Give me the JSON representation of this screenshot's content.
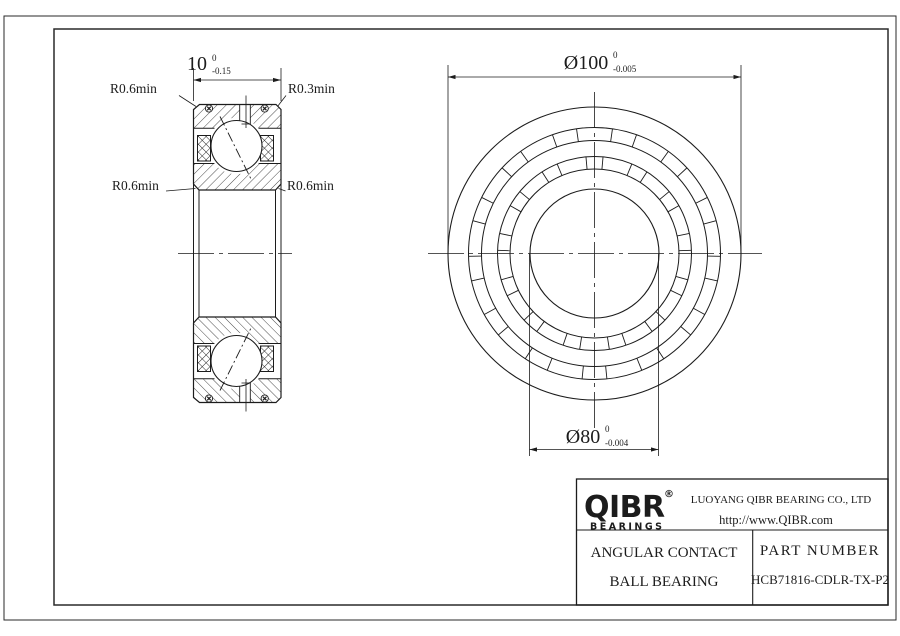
{
  "section_view": {
    "labels": {
      "top_left": "R0.6min",
      "top_right": "R0.3min",
      "mid_left": "R0.6min",
      "mid_right": "R0.6min"
    },
    "width_dim": {
      "value": "10",
      "tol_upper": "0",
      "tol_lower": "-0.15"
    }
  },
  "front_view": {
    "od_dim": {
      "value": "Ø100",
      "tol_upper": "0",
      "tol_lower": "-0.005"
    },
    "bore_dim": {
      "value": "Ø80",
      "tol_upper": "0",
      "tol_lower": "-0.004"
    }
  },
  "title_block": {
    "logo": {
      "text": "QIBR",
      "registered": "®",
      "sub": "BEARINGS"
    },
    "company": "LUOYANG QIBR BEARING CO., LTD",
    "website": "http://www.QIBR.com",
    "product_line1": "ANGULAR CONTACT",
    "product_line2": "BALL BEARING",
    "part_label": "PART NUMBER",
    "part_number": "HCB71816-CDLR-TX-P2"
  },
  "colors": {
    "line": "#1c1c1c",
    "bg": "#ffffff"
  }
}
